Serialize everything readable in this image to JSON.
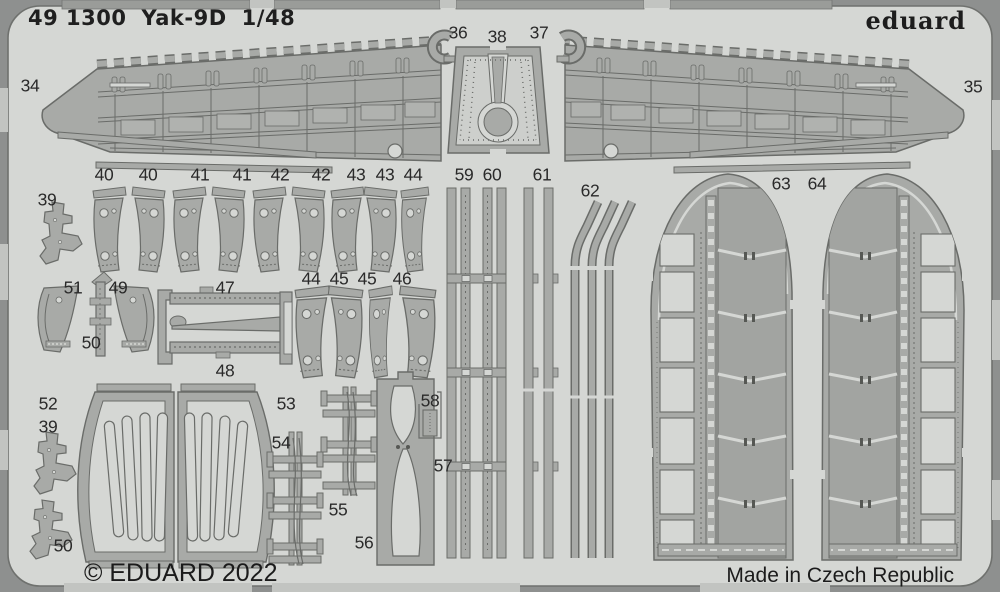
{
  "header": {
    "catalog_number": "49 1300",
    "subject": "Yak-9D",
    "scale": "1/48",
    "brand": "eduard"
  },
  "footer": {
    "copyright": "© EDUARD 2022",
    "origin": "Made in Czech Republic"
  },
  "colors": {
    "sheet": "#d5d7d4",
    "part_fill": "#a8aaa7",
    "part_outline": "#6a6c69",
    "photo_edge": "#8e908f",
    "text": "#1f1f1f"
  },
  "part_labels": [
    {
      "n": "34",
      "x": 30,
      "y": 86
    },
    {
      "n": "35",
      "x": 973,
      "y": 87
    },
    {
      "n": "36",
      "x": 458,
      "y": 33
    },
    {
      "n": "38",
      "x": 497,
      "y": 37
    },
    {
      "n": "37",
      "x": 539,
      "y": 33
    },
    {
      "n": "39",
      "x": 47,
      "y": 200
    },
    {
      "n": "40",
      "x": 104,
      "y": 175
    },
    {
      "n": "40",
      "x": 148,
      "y": 175
    },
    {
      "n": "41",
      "x": 200,
      "y": 175
    },
    {
      "n": "41",
      "x": 242,
      "y": 175
    },
    {
      "n": "42",
      "x": 280,
      "y": 175
    },
    {
      "n": "42",
      "x": 321,
      "y": 175
    },
    {
      "n": "43",
      "x": 356,
      "y": 175
    },
    {
      "n": "43",
      "x": 385,
      "y": 175
    },
    {
      "n": "44",
      "x": 413,
      "y": 175
    },
    {
      "n": "59",
      "x": 464,
      "y": 175
    },
    {
      "n": "60",
      "x": 492,
      "y": 175
    },
    {
      "n": "61",
      "x": 542,
      "y": 175
    },
    {
      "n": "62",
      "x": 590,
      "y": 191
    },
    {
      "n": "63",
      "x": 781,
      "y": 184
    },
    {
      "n": "64",
      "x": 817,
      "y": 184
    },
    {
      "n": "51",
      "x": 73,
      "y": 288
    },
    {
      "n": "49",
      "x": 118,
      "y": 288
    },
    {
      "n": "50",
      "x": 91,
      "y": 343
    },
    {
      "n": "47",
      "x": 225,
      "y": 288
    },
    {
      "n": "48",
      "x": 225,
      "y": 371
    },
    {
      "n": "44",
      "x": 311,
      "y": 279
    },
    {
      "n": "45",
      "x": 339,
      "y": 279
    },
    {
      "n": "45",
      "x": 367,
      "y": 279
    },
    {
      "n": "46",
      "x": 402,
      "y": 279
    },
    {
      "n": "52",
      "x": 48,
      "y": 404
    },
    {
      "n": "39",
      "x": 48,
      "y": 427
    },
    {
      "n": "50",
      "x": 63,
      "y": 546
    },
    {
      "n": "53",
      "x": 286,
      "y": 404
    },
    {
      "n": "54",
      "x": 281,
      "y": 443
    },
    {
      "n": "55",
      "x": 338,
      "y": 510
    },
    {
      "n": "56",
      "x": 364,
      "y": 543
    },
    {
      "n": "57",
      "x": 443,
      "y": 466
    },
    {
      "n": "58",
      "x": 430,
      "y": 401
    }
  ]
}
